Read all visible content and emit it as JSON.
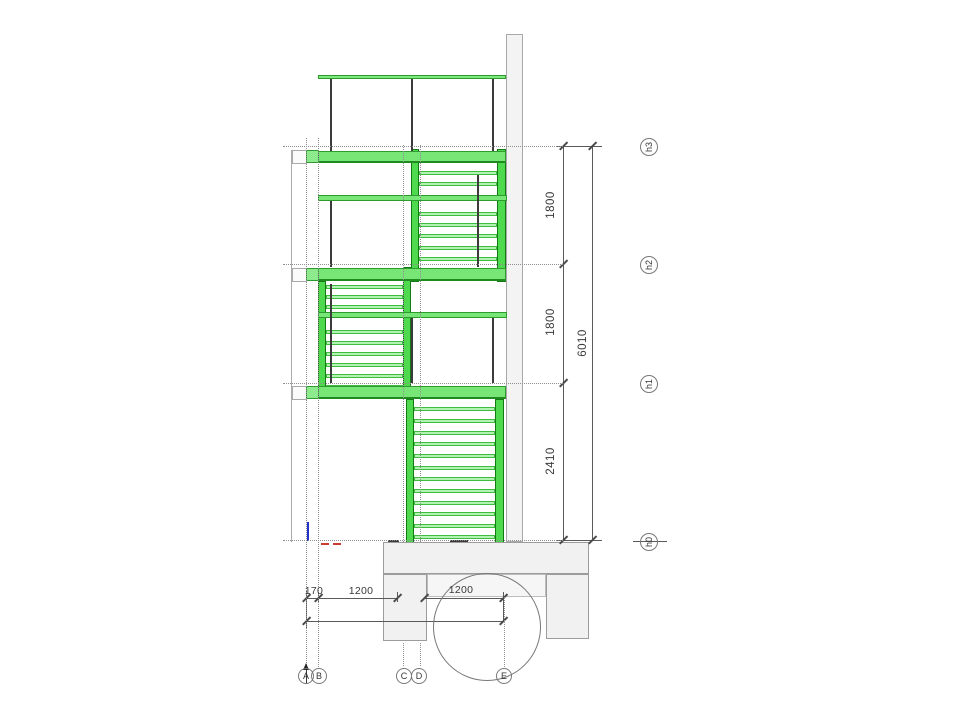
{
  "drawing": {
    "kind": "stair-section-elevation",
    "units": "mm",
    "colors": {
      "stair_green": "#4fd94f",
      "tread_green": "#b2f2b2",
      "slab_green": "#77e677",
      "wall_gray": "#f3f3f3",
      "dim_gray": "#5a5a5a"
    },
    "levels": [
      {
        "label": "h3",
        "y": 146,
        "bubble": {
          "cx": 649,
          "cy": 147
        }
      },
      {
        "label": "h2",
        "y": 264,
        "bubble": {
          "cx": 649,
          "cy": 265
        }
      },
      {
        "label": "h1",
        "y": 383,
        "bubble": {
          "cx": 649,
          "cy": 384
        }
      },
      {
        "label": "h0",
        "y": 540,
        "bubble": {
          "cx": 649,
          "cy": 542
        }
      }
    ],
    "right_dimensions": [
      {
        "label": "1800",
        "cx": 551,
        "cy": 205
      },
      {
        "label": "1800",
        "cx": 551,
        "cy": 322
      },
      {
        "label": "2410",
        "cx": 551,
        "cy": 461
      },
      {
        "label": "6010",
        "cx": 583,
        "cy": 343
      }
    ],
    "bottom_dimensions": [
      {
        "label": "170",
        "cx": 314,
        "cy": 591
      },
      {
        "label": "1200",
        "cx": 361,
        "cy": 591
      },
      {
        "label": "1200",
        "cx": 461,
        "cy": 590
      }
    ],
    "grid_axes": [
      {
        "label": "A",
        "cx": 306,
        "cy": 676
      },
      {
        "label": "B",
        "cx": 319,
        "cy": 676
      },
      {
        "label": "C",
        "cx": 404,
        "cy": 676
      },
      {
        "label": "D",
        "cx": 419,
        "cy": 676
      },
      {
        "label": "E",
        "cx": 504,
        "cy": 676
      }
    ],
    "detail_circle": {
      "cx": 487,
      "cy": 627,
      "r": 54
    },
    "geometry": {
      "rects": [
        {
          "c": "wall",
          "n": "wall-section",
          "x": 506,
          "y": 34,
          "w": 17,
          "h": 508
        },
        {
          "c": "thinv",
          "n": "left-edge-line",
          "x": 291,
          "y": 150,
          "w": 1,
          "h": 392
        },
        {
          "c": "bracket",
          "n": "landing-bracket-h3",
          "x": 292,
          "y": 150,
          "w": 15,
          "h": 14
        },
        {
          "c": "bracket",
          "n": "landing-bracket-h2",
          "x": 292,
          "y": 268,
          "w": 15,
          "h": 14
        },
        {
          "c": "bracket",
          "n": "landing-bracket-h1",
          "x": 292,
          "y": 386,
          "w": 15,
          "h": 14
        },
        {
          "c": "stringer",
          "n": "stair-stringer",
          "x": 411,
          "y": 149,
          "w": 8,
          "h": 133
        },
        {
          "c": "stringer",
          "n": "stair-stringer",
          "x": 497,
          "y": 149,
          "w": 9,
          "h": 133
        },
        {
          "c": "stringer",
          "n": "stair-stringer",
          "x": 318,
          "y": 281,
          "w": 8,
          "h": 118
        },
        {
          "c": "stringer",
          "n": "stair-stringer",
          "x": 403,
          "y": 267,
          "w": 8,
          "h": 132
        },
        {
          "c": "stringer",
          "n": "stair-stringer",
          "x": 406,
          "y": 399,
          "w": 8,
          "h": 144
        },
        {
          "c": "stringer",
          "n": "stair-stringer",
          "x": 495,
          "y": 399,
          "w": 9,
          "h": 144
        },
        {
          "c": "rail",
          "n": "handrail-top",
          "x": 318,
          "y": 75,
          "w": 188,
          "h": 4
        },
        {
          "c": "blockS",
          "n": "landing-step-block-h3",
          "x": 306,
          "y": 150,
          "w": 13,
          "h": 13
        },
        {
          "c": "slab",
          "n": "landing-slab-h3",
          "x": 318,
          "y": 151,
          "w": 188,
          "h": 12
        },
        {
          "c": "tread",
          "n": "tread",
          "x": 419,
          "y": 171,
          "w": 78,
          "h": 4
        },
        {
          "c": "tread",
          "n": "tread",
          "x": 419,
          "y": 182,
          "w": 78,
          "h": 4
        },
        {
          "c": "midbar",
          "n": "mid-landing-upper",
          "x": 318,
          "y": 195,
          "w": 189,
          "h": 6
        },
        {
          "c": "tread",
          "n": "tread",
          "x": 419,
          "y": 212,
          "w": 78,
          "h": 4
        },
        {
          "c": "tread",
          "n": "tread",
          "x": 419,
          "y": 223,
          "w": 78,
          "h": 4
        },
        {
          "c": "tread",
          "n": "tread",
          "x": 419,
          "y": 234,
          "w": 78,
          "h": 4
        },
        {
          "c": "tread",
          "n": "tread",
          "x": 419,
          "y": 246,
          "w": 78,
          "h": 4
        },
        {
          "c": "tread",
          "n": "tread",
          "x": 419,
          "y": 257,
          "w": 78,
          "h": 4
        },
        {
          "c": "blockS",
          "n": "landing-step-block-h2",
          "x": 306,
          "y": 268,
          "w": 13,
          "h": 13
        },
        {
          "c": "slab",
          "n": "landing-slab-h2",
          "x": 318,
          "y": 268,
          "w": 188,
          "h": 13
        },
        {
          "c": "tread",
          "n": "tread",
          "x": 326,
          "y": 285,
          "w": 77,
          "h": 4
        },
        {
          "c": "tread",
          "n": "tread",
          "x": 326,
          "y": 295,
          "w": 77,
          "h": 4
        },
        {
          "c": "tread",
          "n": "tread",
          "x": 326,
          "y": 305,
          "w": 77,
          "h": 4
        },
        {
          "c": "midbar",
          "n": "mid-landing-lower",
          "x": 318,
          "y": 312,
          "w": 189,
          "h": 6
        },
        {
          "c": "tread",
          "n": "tread",
          "x": 326,
          "y": 330,
          "w": 77,
          "h": 4
        },
        {
          "c": "tread",
          "n": "tread",
          "x": 326,
          "y": 341,
          "w": 77,
          "h": 4
        },
        {
          "c": "tread",
          "n": "tread",
          "x": 326,
          "y": 352,
          "w": 77,
          "h": 4
        },
        {
          "c": "tread",
          "n": "tread",
          "x": 326,
          "y": 363,
          "w": 77,
          "h": 4
        },
        {
          "c": "tread",
          "n": "tread",
          "x": 326,
          "y": 374,
          "w": 77,
          "h": 4
        },
        {
          "c": "tread",
          "n": "tread",
          "x": 326,
          "y": 385,
          "w": 77,
          "h": 4
        },
        {
          "c": "blockS",
          "n": "landing-step-block-h1",
          "x": 306,
          "y": 386,
          "w": 13,
          "h": 13
        },
        {
          "c": "slab",
          "n": "landing-slab-h1",
          "x": 318,
          "y": 386,
          "w": 188,
          "h": 13
        },
        {
          "c": "tread",
          "n": "tread",
          "x": 414,
          "y": 407,
          "w": 81,
          "h": 4
        },
        {
          "c": "tread",
          "n": "tread",
          "x": 414,
          "y": 419,
          "w": 81,
          "h": 4
        },
        {
          "c": "tread",
          "n": "tread",
          "x": 414,
          "y": 431,
          "w": 81,
          "h": 4
        },
        {
          "c": "tread",
          "n": "tread",
          "x": 414,
          "y": 442,
          "w": 81,
          "h": 4
        },
        {
          "c": "tread",
          "n": "tread",
          "x": 414,
          "y": 454,
          "w": 81,
          "h": 4
        },
        {
          "c": "tread",
          "n": "tread",
          "x": 414,
          "y": 466,
          "w": 81,
          "h": 4
        },
        {
          "c": "tread",
          "n": "tread",
          "x": 414,
          "y": 477,
          "w": 81,
          "h": 4
        },
        {
          "c": "tread",
          "n": "tread",
          "x": 414,
          "y": 489,
          "w": 81,
          "h": 4
        },
        {
          "c": "tread",
          "n": "tread",
          "x": 414,
          "y": 501,
          "w": 81,
          "h": 4
        },
        {
          "c": "tread",
          "n": "tread",
          "x": 414,
          "y": 512,
          "w": 81,
          "h": 4
        },
        {
          "c": "tread",
          "n": "tread",
          "x": 414,
          "y": 524,
          "w": 81,
          "h": 4
        },
        {
          "c": "tread",
          "n": "tread",
          "x": 414,
          "y": 535,
          "w": 81,
          "h": 4
        },
        {
          "c": "post",
          "n": "handrail-post",
          "x": 330,
          "y": 79,
          "w": 2,
          "h": 72
        },
        {
          "c": "post",
          "n": "handrail-post",
          "x": 411,
          "y": 79,
          "w": 2,
          "h": 72
        },
        {
          "c": "post",
          "n": "handrail-post",
          "x": 492,
          "y": 79,
          "w": 2,
          "h": 72
        },
        {
          "c": "post",
          "n": "handrail-post",
          "x": 330,
          "y": 201,
          "w": 2,
          "h": 66
        },
        {
          "c": "post",
          "n": "handrail-post",
          "x": 477,
          "y": 175,
          "w": 2,
          "h": 92
        },
        {
          "c": "post",
          "n": "handrail-post",
          "x": 330,
          "y": 284,
          "w": 2,
          "h": 99
        },
        {
          "c": "post",
          "n": "handrail-post",
          "x": 411,
          "y": 318,
          "w": 2,
          "h": 65
        },
        {
          "c": "post",
          "n": "handrail-post",
          "x": 492,
          "y": 318,
          "w": 2,
          "h": 65
        },
        {
          "c": "found",
          "n": "foundation-slab",
          "x": 383,
          "y": 542,
          "w": 206,
          "h": 32
        },
        {
          "c": "found",
          "n": "foundation-pier-left",
          "x": 383,
          "y": 574,
          "w": 44,
          "h": 67
        },
        {
          "c": "found",
          "n": "foundation-pier-right",
          "x": 546,
          "y": 574,
          "w": 43,
          "h": 65
        },
        {
          "c": "found2",
          "n": "foundation-strip",
          "x": 427,
          "y": 574,
          "w": 119,
          "h": 23
        },
        {
          "c": "blue",
          "n": "reference-mark-blue",
          "x": 307,
          "y": 522,
          "w": 2,
          "h": 19
        },
        {
          "c": "red",
          "n": "ground-mark-red",
          "x": 321,
          "y": 543,
          "w": 8,
          "h": 2
        },
        {
          "c": "red",
          "n": "ground-mark-red",
          "x": 333,
          "y": 543,
          "w": 8,
          "h": 2
        },
        {
          "c": "darkd",
          "n": "ground-mark-dark",
          "x": 388,
          "y": 540,
          "w": 11,
          "h": 3
        },
        {
          "c": "darkd",
          "n": "ground-mark-dark",
          "x": 450,
          "y": 540,
          "w": 18,
          "h": 3
        },
        {
          "c": "darkd",
          "n": "axis-a-arrow-stem",
          "x": 306,
          "y": 666,
          "w": 1,
          "h": 18
        }
      ],
      "dotted_v": [
        {
          "x": 306,
          "y": 138,
          "h": 529,
          "n": "grid-line-a"
        },
        {
          "x": 318,
          "y": 138,
          "h": 529,
          "n": "grid-line-b"
        },
        {
          "x": 403,
          "y": 145,
          "h": 397,
          "n": "grid-line-c"
        },
        {
          "x": 420,
          "y": 145,
          "h": 397,
          "n": "grid-line-d"
        },
        {
          "x": 403,
          "y": 643,
          "h": 23,
          "n": "grid-line-c-lower"
        },
        {
          "x": 420,
          "y": 643,
          "h": 23,
          "n": "grid-line-d-lower"
        },
        {
          "x": 504,
          "y": 597,
          "h": 70,
          "n": "grid-line-e-lower"
        }
      ],
      "dotted_h": [
        {
          "x": 283,
          "y": 146,
          "w": 280,
          "n": "level-line-h3"
        },
        {
          "x": 283,
          "y": 264,
          "w": 280,
          "n": "level-line-h2"
        },
        {
          "x": 283,
          "y": 383,
          "w": 280,
          "n": "level-line-h1"
        },
        {
          "x": 283,
          "y": 540,
          "w": 280,
          "n": "level-line-h0"
        }
      ],
      "dim_segments": [
        {
          "x": 563,
          "y": 146,
          "w": 1,
          "h": 394,
          "n": "dim-line-storey"
        },
        {
          "x": 592,
          "y": 146,
          "w": 1,
          "h": 394,
          "n": "dim-line-overall"
        },
        {
          "x": 556,
          "y": 146,
          "w": 46,
          "h": 1,
          "n": "dim-extension-top"
        },
        {
          "x": 556,
          "y": 540,
          "w": 46,
          "h": 1,
          "n": "dim-extension-bottom"
        },
        {
          "x": 306,
          "y": 598,
          "w": 91,
          "h": 1,
          "n": "dim-line-bottom-1"
        },
        {
          "x": 424,
          "y": 598,
          "w": 79,
          "h": 1,
          "n": "dim-line-bottom-2"
        },
        {
          "x": 306,
          "y": 621,
          "w": 197,
          "h": 1,
          "n": "dim-line-bottom-3"
        },
        {
          "x": 306,
          "y": 590,
          "w": 1,
          "h": 38,
          "n": "dim-extension"
        },
        {
          "x": 318,
          "y": 592,
          "w": 1,
          "h": 10,
          "n": "dim-extension"
        },
        {
          "x": 397,
          "y": 592,
          "w": 1,
          "h": 10,
          "n": "dim-extension"
        },
        {
          "x": 503,
          "y": 592,
          "w": 1,
          "h": 29,
          "n": "dim-extension"
        },
        {
          "x": 633,
          "y": 541,
          "w": 34,
          "h": 1,
          "n": "level-h0-datum-line"
        }
      ],
      "ticks": [
        {
          "x": 563,
          "y": 146
        },
        {
          "x": 563,
          "y": 264
        },
        {
          "x": 563,
          "y": 383
        },
        {
          "x": 563,
          "y": 540
        },
        {
          "x": 592,
          "y": 146
        },
        {
          "x": 592,
          "y": 540
        },
        {
          "x": 306,
          "y": 598
        },
        {
          "x": 318,
          "y": 598
        },
        {
          "x": 397,
          "y": 598
        },
        {
          "x": 424,
          "y": 598
        },
        {
          "x": 503,
          "y": 598
        },
        {
          "x": 306,
          "y": 621
        },
        {
          "x": 503,
          "y": 621
        }
      ]
    }
  }
}
